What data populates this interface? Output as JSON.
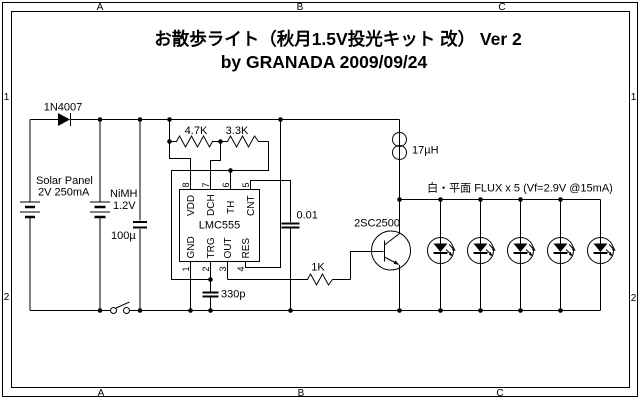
{
  "frame": {
    "top": [
      "A",
      "B",
      "C"
    ],
    "bottom": [
      "A",
      "B",
      "C"
    ],
    "left": [
      "1",
      "2"
    ],
    "right": [
      "1",
      "2"
    ]
  },
  "title": {
    "line1": "お散歩ライト（秋月1.5V投光キット 改） Ver 2",
    "line2": "by GRANADA 2009/09/24"
  },
  "power": {
    "diode": "1N4007",
    "solar_line1": "Solar Panel",
    "solar_line2": "2V 250mA",
    "battery_line1": "NiMH",
    "battery_line2": "1.2V",
    "cap_filter": "100µ"
  },
  "oscillator": {
    "r1": "4.7K",
    "r2": "3.3K",
    "ic": "LMC555",
    "pins_top": [
      {
        "num": "8",
        "name": "VDD"
      },
      {
        "num": "7",
        "name": "DCH"
      },
      {
        "num": "6",
        "name": "TH"
      },
      {
        "num": "5",
        "name": "CNT"
      }
    ],
    "pins_bottom": [
      {
        "num": "1",
        "name": "GND"
      },
      {
        "num": "2",
        "name": "TRG"
      },
      {
        "num": "3",
        "name": "OUT"
      },
      {
        "num": "4",
        "name": "RES"
      }
    ],
    "cap_control": "0.01",
    "cap_timing": "330p"
  },
  "driver": {
    "inductor": "17µH",
    "base_resistor": "1K",
    "transistor": "2SC2500"
  },
  "leds": {
    "label": "白・平面 FLUX x 5 (Vf=2.9V @15mA)",
    "count": 5
  }
}
